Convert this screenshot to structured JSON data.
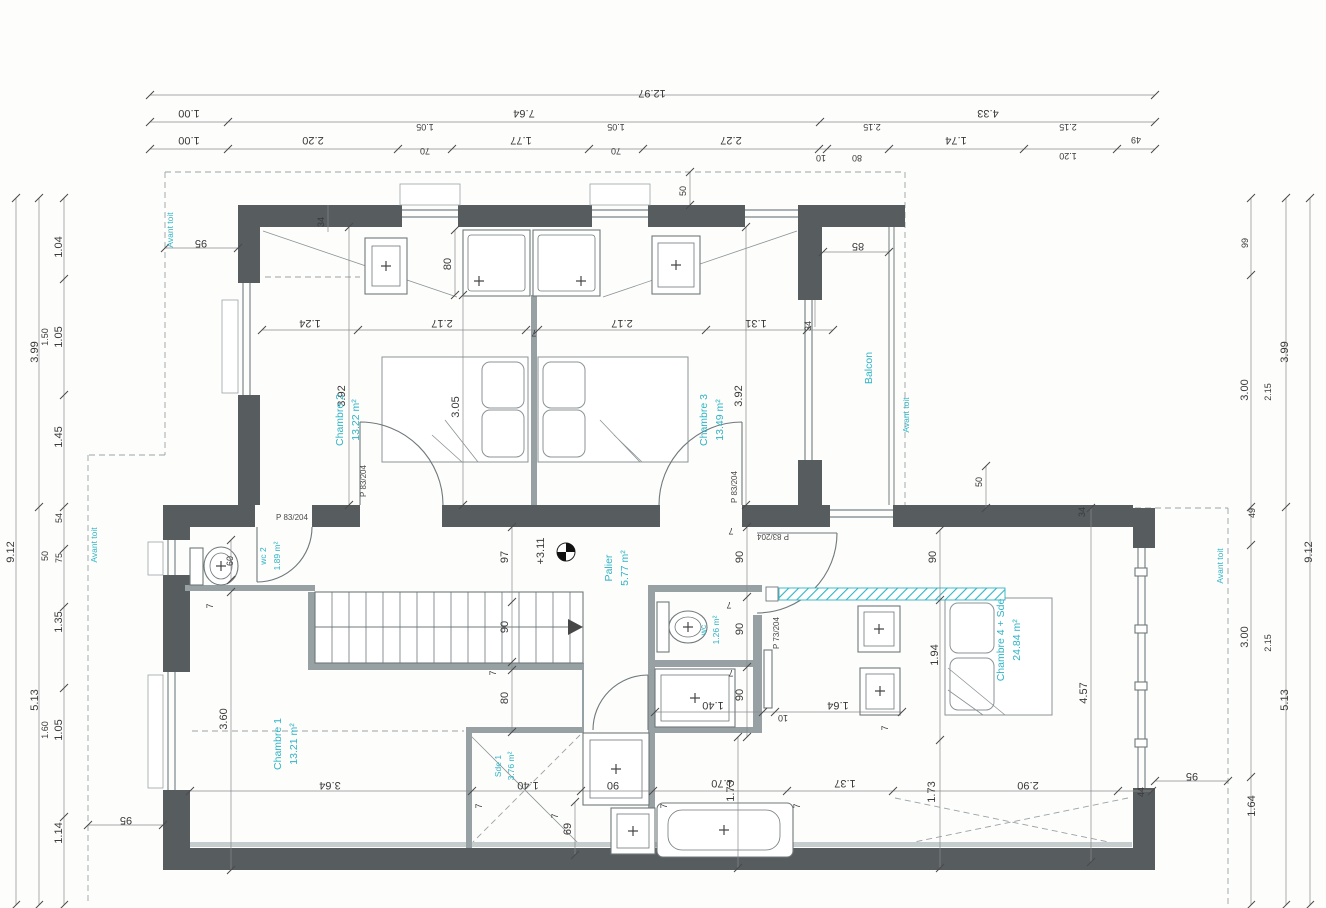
{
  "colors": {
    "wall": "#575c5f",
    "partition": "#97a1a4",
    "accent_cyan": "#2fb4c6",
    "dim_text": "#3a3a3a"
  },
  "rooms": {
    "c2": {
      "name": "Chambre 2",
      "area": "13.22 m²"
    },
    "c3": {
      "name": "Chambre 3",
      "area": "13.49 m²"
    },
    "c1": {
      "name": "Chambre 1",
      "area": "13.21 m²"
    },
    "c4": {
      "name": "Chambre 4 + Sde",
      "area": "24.84 m²"
    },
    "palier": {
      "name": "Palier",
      "area": "5.77 m²"
    },
    "wc2": {
      "name": "wc 2",
      "area": "1.89 m²"
    },
    "wc1": {
      "name": "wc",
      "area": "1.26 m²"
    },
    "sde1": {
      "name": "Sde 1",
      "area": "3.76 m²"
    }
  },
  "annotations": {
    "avant_toit": "Avant toit",
    "balcon": "Balcon"
  },
  "doors": {
    "d83": "P 83/204",
    "d73": "P 73/204"
  },
  "dims": {
    "level": "+3.11",
    "top": {
      "total": "12.97",
      "r2": [
        "1.00",
        "7.64",
        "4.33"
      ],
      "r3": [
        "1.00",
        "2.20",
        "70",
        "1.77",
        "70",
        "2.27",
        "1.74",
        "49"
      ],
      "r3b": [
        "10",
        "80",
        "1.20"
      ],
      "sub": [
        "1.05",
        "1.05",
        "2.15",
        "2.15"
      ]
    },
    "left": {
      "total": "9.12",
      "mid": [
        "3.99",
        "5.13"
      ],
      "inner": [
        "1.04",
        "1.05",
        "1.45",
        "54",
        "75",
        "1.35",
        "1.05",
        "1.14"
      ],
      "inner2": [
        "1.50",
        "50",
        "1.60"
      ],
      "eave": [
        "95",
        "95"
      ]
    },
    "right": {
      "total": "9.12",
      "mid": [
        "3.99",
        "5.13"
      ],
      "sub": [
        "2.15",
        "2.15"
      ],
      "inner": [
        "99",
        "3.00",
        "49",
        "3.00",
        "1.64"
      ],
      "eave": "95"
    },
    "plan": {
      "h": [
        "1.24",
        "2.17",
        "2.17",
        "1.31",
        "85",
        "1.40",
        "10",
        "1.64",
        "3.64",
        "1.40",
        "90",
        "1.70",
        "1.37",
        "2.90"
      ],
      "v": [
        "34",
        "80",
        "3.92",
        "3.05",
        "3.92",
        "34",
        "50",
        "50",
        "97",
        "60",
        "90",
        "80",
        "3.60",
        "90",
        "90",
        "90",
        "90",
        "1.94",
        "4.57",
        "34",
        "69",
        "1.73",
        "1.73",
        "44"
      ],
      "seven": "7"
    }
  }
}
